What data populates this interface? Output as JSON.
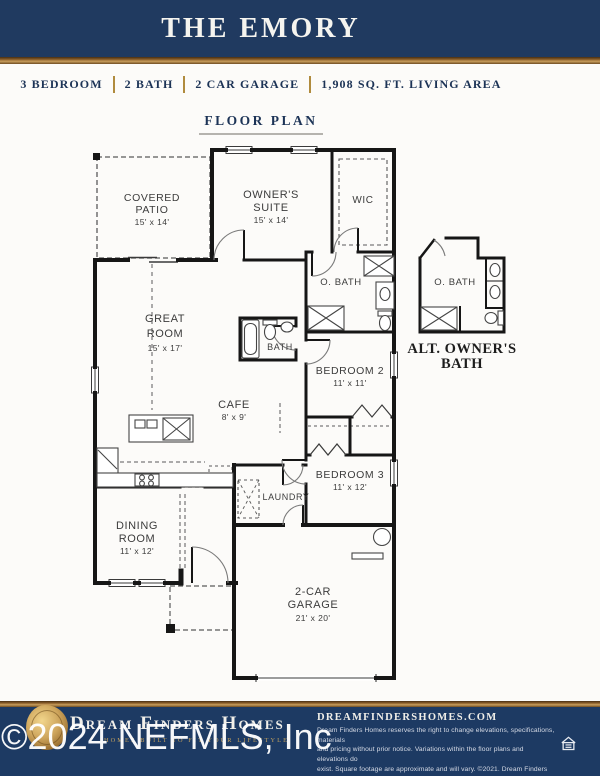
{
  "header": {
    "title": "THE EMORY"
  },
  "specs": {
    "bedrooms": "3 BEDROOM",
    "baths": "2 BATH",
    "garage": "2 CAR GARAGE",
    "area": "1,908 SQ. FT. LIVING AREA"
  },
  "floor_plan": {
    "section_label": "FLOOR PLAN",
    "rooms": {
      "covered_patio": {
        "line1": "COVERED",
        "line2": "PATIO",
        "dims": "15' x 14'"
      },
      "owners_suite": {
        "line1": "OWNER'S",
        "line2": "SUITE",
        "dims": "15' x 14'"
      },
      "wic": {
        "label": "WIC"
      },
      "owners_bath": {
        "label": "O. BATH"
      },
      "alt_owners_bath": {
        "label": "O. BATH"
      },
      "hall_bath": {
        "label": "BATH"
      },
      "great_room": {
        "line1": "GREAT",
        "line2": "ROOM",
        "dims": "15' x 17'"
      },
      "cafe": {
        "label": "CAFE",
        "dims": "8' x 9'"
      },
      "bedroom_2": {
        "label": "BEDROOM 2",
        "dims": "11' x 11'"
      },
      "bedroom_3": {
        "label": "BEDROOM 3",
        "dims": "11' x 12'"
      },
      "dining_room": {
        "line1": "DINING",
        "line2": "ROOM",
        "dims": "11' x 12'"
      },
      "laundry": {
        "label": "LAUNDRY"
      },
      "garage": {
        "line1": "2-CAR",
        "line2": "GARAGE",
        "dims": "21' x 20'"
      }
    },
    "alt_bath_caption": {
      "line1": "ALT. OWNER'S",
      "line2": "BATH"
    }
  },
  "footer": {
    "brand": "Dream Finders Homes",
    "tagline": "HOMES BUILT TO FIT YOUR LIFESTYLE",
    "website": "DREAMFINDERSHOMES.COM",
    "disclaimer_lines": [
      "Dream Finders Homes reserves the right to change elevations, specifications, materials",
      "and pricing without prior notice. Variations within the floor plans and elevations do",
      "exist. Square footage are approximate and will vary. ©2021. Dream Finders Homes",
      "CBC1257579.  1/21"
    ]
  },
  "watermark": "©2024 NEFMLS, Inc",
  "colors": {
    "header_navy": "#203a60",
    "footer_navy": "#1d3a63",
    "gold": "#b08b3e",
    "wall": "#161616"
  }
}
